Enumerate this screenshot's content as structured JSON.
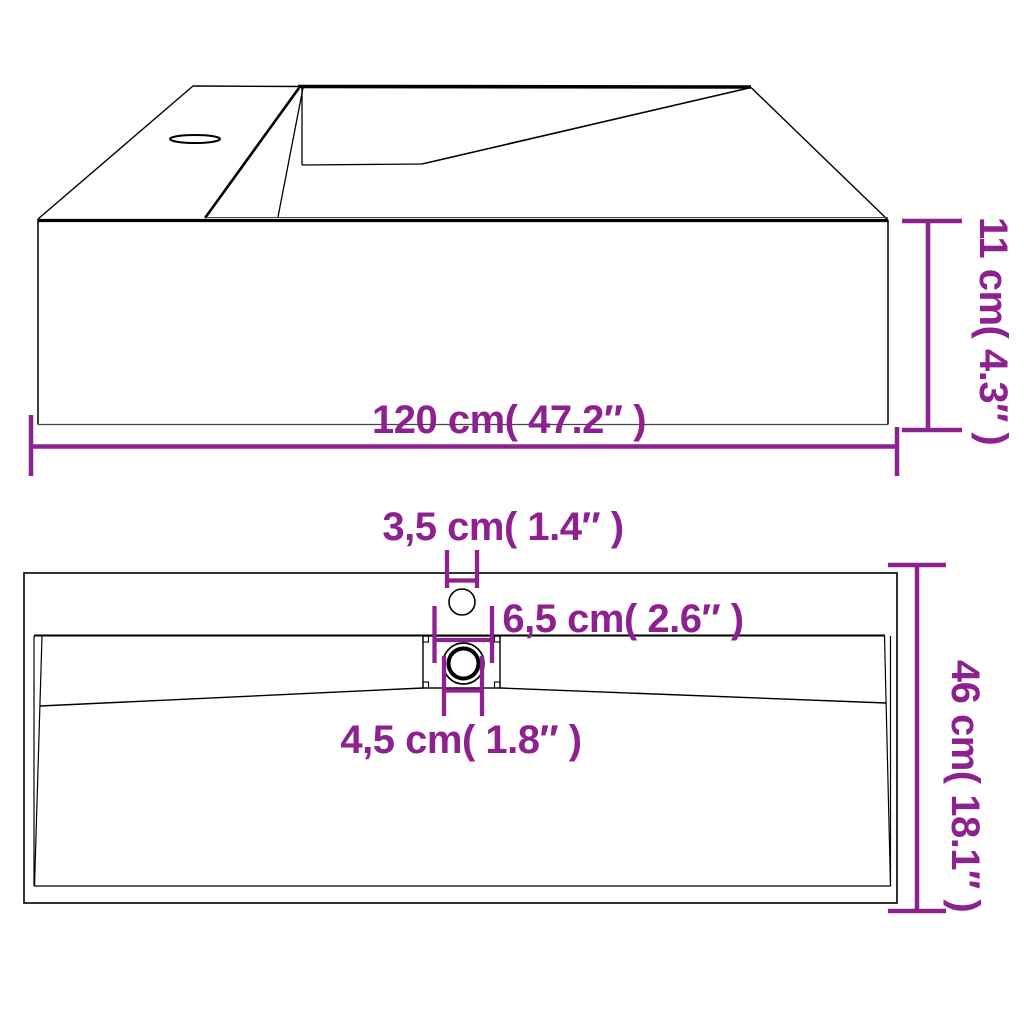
{
  "page": {
    "description": "Washbasin technical dimension diagram, two views on white background",
    "background": "#ffffff"
  },
  "colors": {
    "dimension": "#8E2190",
    "line": "#000000"
  },
  "top_view": {
    "name": "washbasin-perspective-view",
    "width_label": "120 cm( 47.2″ )",
    "height_label": "11 cm( 4.3″ )"
  },
  "plan_view": {
    "name": "washbasin-plan-view",
    "faucet_hole_label": "3,5 cm( 1.4″ )",
    "drain_flange_label": "6,5 cm( 2.6″ )",
    "drain_hole_label": "4,5 cm( 1.8″ )",
    "depth_label": "46 cm( 18.1″ )"
  }
}
